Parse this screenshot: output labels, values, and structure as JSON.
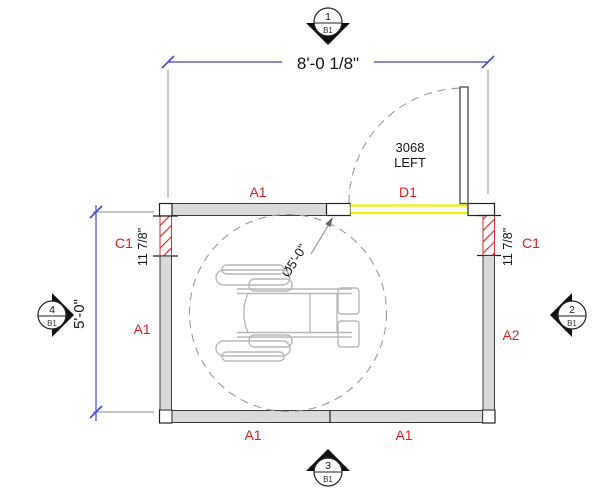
{
  "drawing": {
    "type": "floor-plan",
    "colors": {
      "wall_fill": "#d9d9d9",
      "outline": "#3c3c3c",
      "label_red": "#e02020",
      "dimension_blue": "#4646d2",
      "door_opening_yellow": "#f0f000",
      "clearance_dash_gray": "#9a9a9a",
      "wheelchair_gray": "#b8b8b8"
    },
    "dimensions": {
      "overall_width": "8'-0 1/8\"",
      "overall_height": "5'-0\"",
      "left_wall_segment": "11 7/8\"",
      "right_wall_segment": "11 7/8\"",
      "clearance_circle": "Ø5'-0\""
    },
    "walls": {
      "top": "A1",
      "left": "A1",
      "right": "A2",
      "bottom_left": "A1",
      "bottom_right": "A1",
      "corner_left": "C1",
      "corner_right": "C1"
    },
    "door": {
      "tag": "D1",
      "size": "3068",
      "hand": "LEFT"
    },
    "elevation_markers": {
      "top": {
        "number": "1",
        "sheet": "B1"
      },
      "right": {
        "number": "2",
        "sheet": "B1"
      },
      "bottom": {
        "number": "3",
        "sheet": "B1"
      },
      "left": {
        "number": "4",
        "sheet": "B1"
      }
    }
  }
}
